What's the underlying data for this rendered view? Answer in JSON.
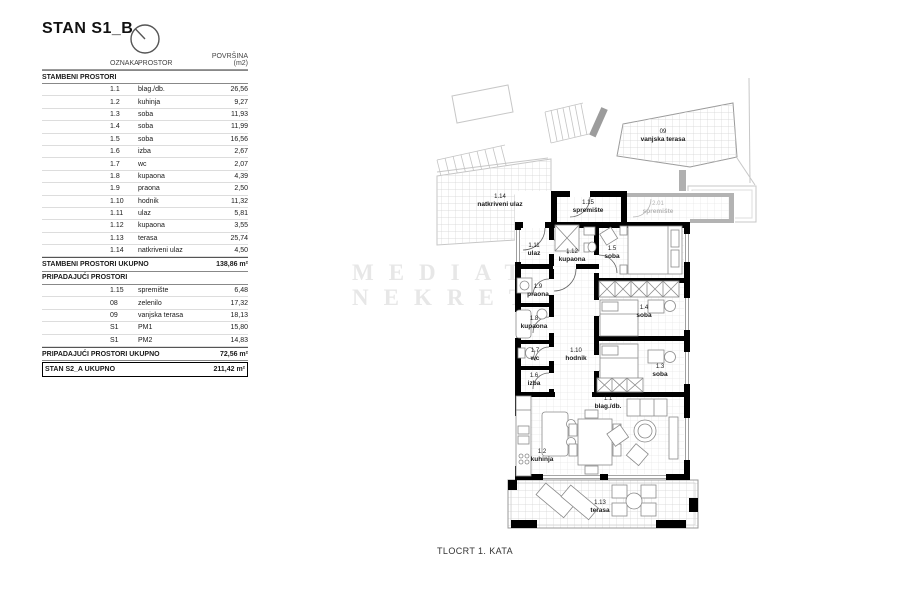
{
  "title": "STAN S1_B",
  "caption": "TLOCRT 1. KATA",
  "watermark": {
    "line1": "MEDIATOR",
    "line2": "NEKRETNINE"
  },
  "colors": {
    "wall": "#000000",
    "gray_wall": "#b3b3b3",
    "context_line": "#c7c7c7",
    "grid_line": "#e3e3e3",
    "outdoor_grid_line": "#d2d2d2",
    "furniture_line": "#8a8a8a",
    "watermark": "#e7e7e7"
  },
  "table": {
    "headers": {
      "oznaka": "OZNAKA",
      "prostor": "PROSTOR",
      "povrsina": "POVRŠINA (m2)"
    },
    "section1_label": "STAMBENI PROSTORI",
    "rows1": [
      {
        "code": "1.1",
        "name": "blag./db.",
        "area": "26,56"
      },
      {
        "code": "1.2",
        "name": "kuhinja",
        "area": "9,27"
      },
      {
        "code": "1.3",
        "name": "soba",
        "area": "11,93"
      },
      {
        "code": "1.4",
        "name": "soba",
        "area": "11,99"
      },
      {
        "code": "1.5",
        "name": "soba",
        "area": "16,56"
      },
      {
        "code": "1.6",
        "name": "izba",
        "area": "2,67"
      },
      {
        "code": "1.7",
        "name": "wc",
        "area": "2,07"
      },
      {
        "code": "1.8",
        "name": "kupaona",
        "area": "4,39"
      },
      {
        "code": "1.9",
        "name": "praona",
        "area": "2,50"
      },
      {
        "code": "1.10",
        "name": "hodnik",
        "area": "11,32"
      },
      {
        "code": "1.11",
        "name": "ulaz",
        "area": "5,81"
      },
      {
        "code": "1.12",
        "name": "kupaona",
        "area": "3,55"
      },
      {
        "code": "1.13",
        "name": "terasa",
        "area": "25,74"
      },
      {
        "code": "1.14",
        "name": "natkriveni ulaz",
        "area": "4,50"
      }
    ],
    "total1": {
      "label": "STAMBENI PROSTORI UKUPNO",
      "value": "138,86 m²"
    },
    "section2_label": "PRIPADAJUĆI PROSTORI",
    "rows2": [
      {
        "code": "1.15",
        "name": "spremište",
        "area": "6,48"
      },
      {
        "code": "08",
        "name": "zelenilo",
        "area": "17,32"
      },
      {
        "code": "09",
        "name": "vanjska terasa",
        "area": "18,13"
      },
      {
        "code": "S1",
        "name": "PM1",
        "area": "15,80"
      },
      {
        "code": "S1",
        "name": "PM2",
        "area": "14,83"
      }
    ],
    "total2": {
      "label": "PRIPADAJUĆI PROSTORI UKUPNO",
      "value": "72,56 m²"
    },
    "grand_total": {
      "label": "STAN S2_A UKUPNO",
      "value": "211,42 m²"
    }
  },
  "plan": {
    "labels": [
      {
        "code": "09",
        "name": "vanjska terasa"
      },
      {
        "code": "1.14",
        "name": "natkriveni ulaz"
      },
      {
        "code": "1.15",
        "name": "spremište"
      },
      {
        "code": "2.01",
        "name": "spremište"
      },
      {
        "code": "1.11",
        "name": "ulaz"
      },
      {
        "code": "1.12",
        "name": "kupaona"
      },
      {
        "code": "1.5",
        "name": "soba"
      },
      {
        "code": "1.9",
        "name": "praona"
      },
      {
        "code": "1.8",
        "name": "kupaona"
      },
      {
        "code": "1.4",
        "name": "soba"
      },
      {
        "code": "1.7",
        "name": "wc"
      },
      {
        "code": "1.10",
        "name": "hodnik"
      },
      {
        "code": "1.3",
        "name": "soba"
      },
      {
        "code": "1.6",
        "name": "izba"
      },
      {
        "code": "1.1",
        "name": "blag./db."
      },
      {
        "code": "1.2",
        "name": "kuhinja"
      },
      {
        "code": "1.13",
        "name": "terasa"
      }
    ]
  }
}
